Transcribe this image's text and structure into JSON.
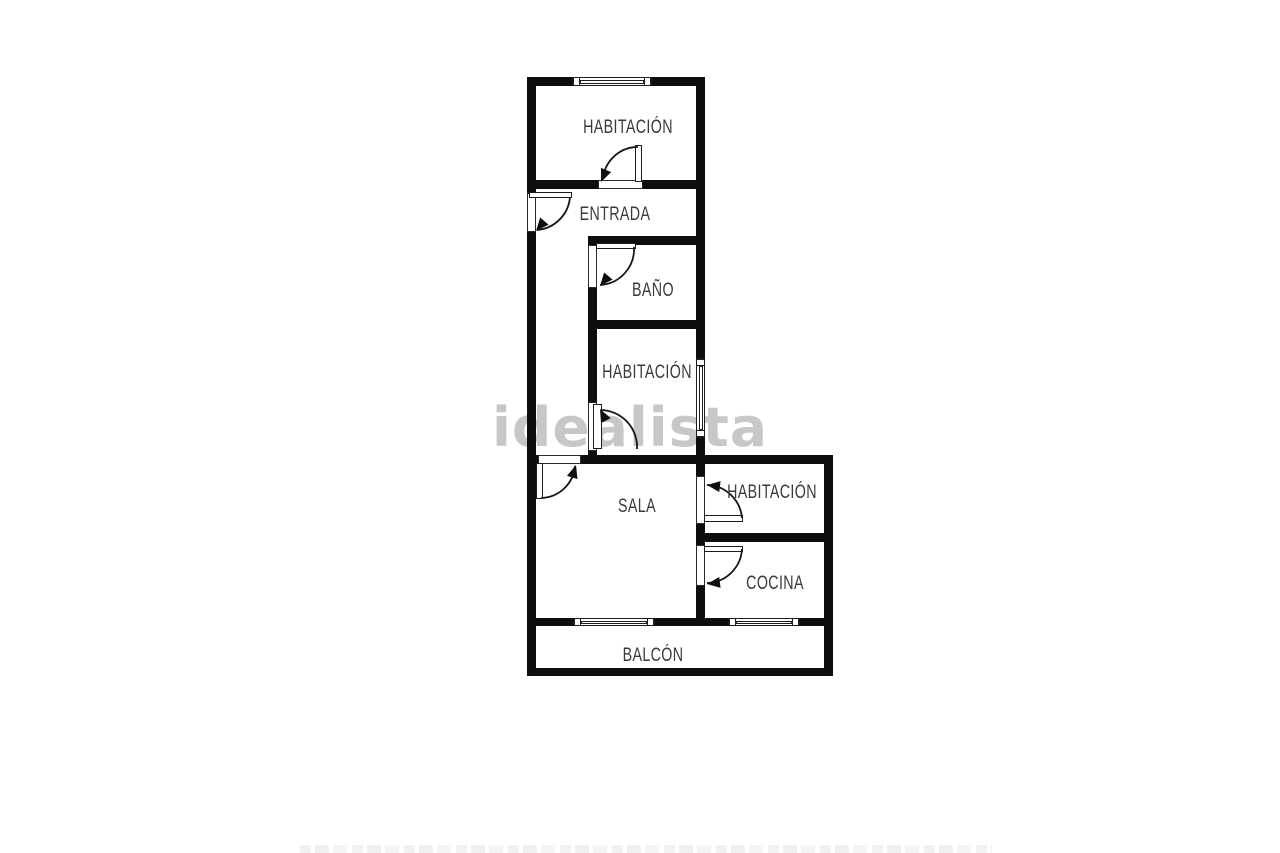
{
  "plan": {
    "watermark": "idealista",
    "rooms": [
      {
        "id": "habitacion-top",
        "label": "HABITACIÓN"
      },
      {
        "id": "entrada",
        "label": "ENTRADA"
      },
      {
        "id": "bano",
        "label": "BAÑO"
      },
      {
        "id": "habitacion-middle",
        "label": "HABITACIÓN"
      },
      {
        "id": "sala",
        "label": "SALA"
      },
      {
        "id": "habitacion-right",
        "label": "HABITACIÓN"
      },
      {
        "id": "cocina",
        "label": "COCINA"
      },
      {
        "id": "balcon",
        "label": "BALCÓN"
      }
    ],
    "features": {
      "doors": 7,
      "windows": 4,
      "entrance_door_wall": "left"
    },
    "colors": {
      "background": "#ffffff",
      "wall": "#0e0e0e",
      "label_text": "#3a3a3a",
      "watermark": "#c7c7c7"
    }
  }
}
